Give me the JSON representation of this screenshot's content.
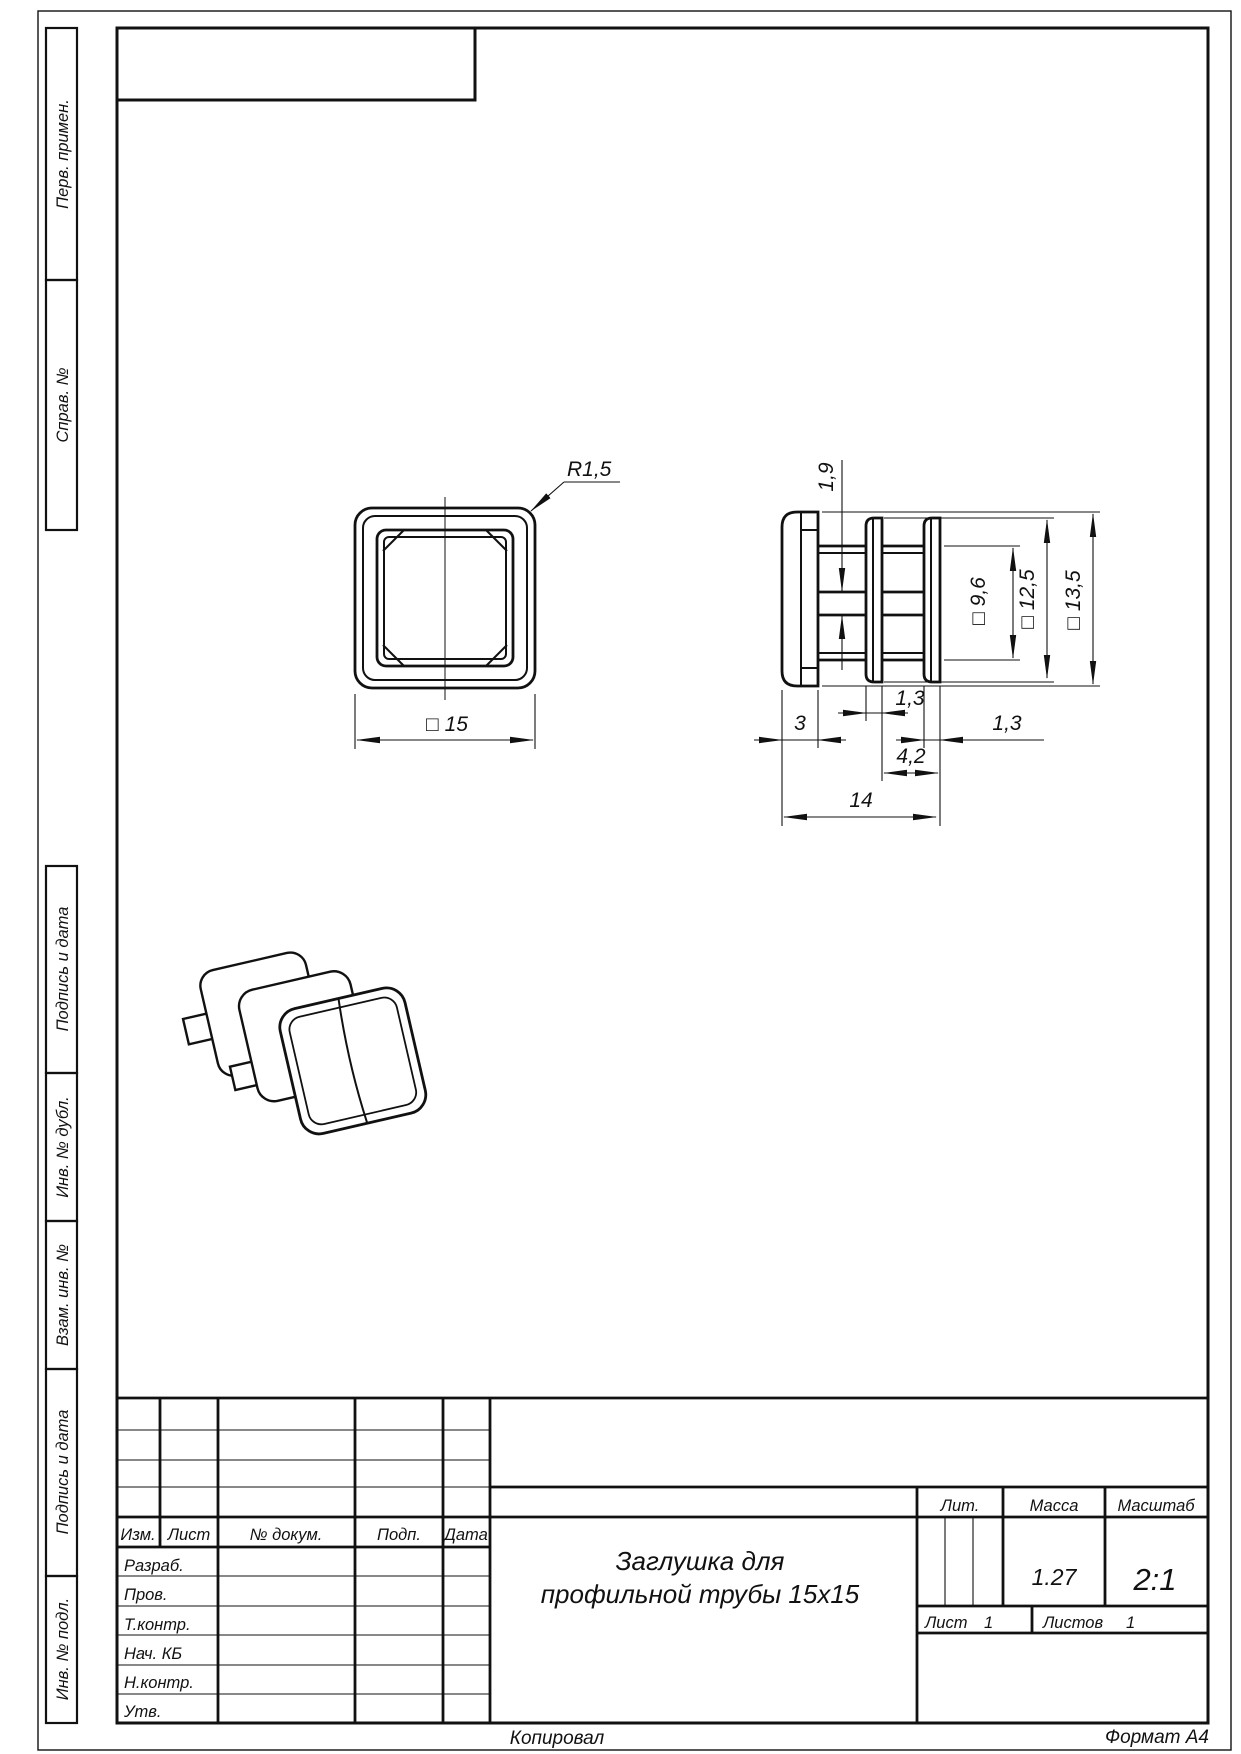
{
  "page": {
    "bottom_left_note": "Копировал",
    "bottom_right_note": "Формат  А4"
  },
  "margin_column": {
    "perv_primen": "Перв. примен.",
    "sprav_no": "Справ. №",
    "podpis_i_data_upper": "Подпись и дата",
    "inv_no_dubl": "Инв. № дубл.",
    "vzam_inv_no": "Взам. инв. №",
    "podpis_i_data_lower": "Подпись и дата",
    "inv_no_podl": "Инв. № подл."
  },
  "title_block": {
    "change_header": {
      "izm": "Изм.",
      "list": "Лист",
      "no_dokum": "№ докум.",
      "podp": "Подп.",
      "data": "Дата"
    },
    "signature_rows": {
      "razrab": "Разраб.",
      "prov": "Пров.",
      "t_kontr": "Т.контр.",
      "nach_kb": "Нач. КБ",
      "n_kontr": "Н.контр.",
      "utv": "Утв."
    },
    "part_name_line1": "Заглушка для",
    "part_name_line2": "профильной трубы 15х15",
    "lit_label": "Лит.",
    "mass_label": "Масса",
    "mass_value": "1.27",
    "scale_label": "Масштаб",
    "scale_value": "2:1",
    "sheet_label": "Лист",
    "sheet_value": "1",
    "sheets_label": "Листов",
    "sheets_value": "1"
  },
  "drawing": {
    "front_view": {
      "corner_radius": "R1,5",
      "outer_size": "□ 15"
    },
    "side_view": {
      "rib_thickness": "1,9",
      "inner_square": "□ 9,6",
      "flange_square": "□ 12,5",
      "cap_square": "□ 13,5",
      "mid_flange_width": "1,3",
      "cap_depth": "3",
      "end_flange_width": "1,3",
      "flange_span": "4,2",
      "total_length": "14"
    }
  }
}
